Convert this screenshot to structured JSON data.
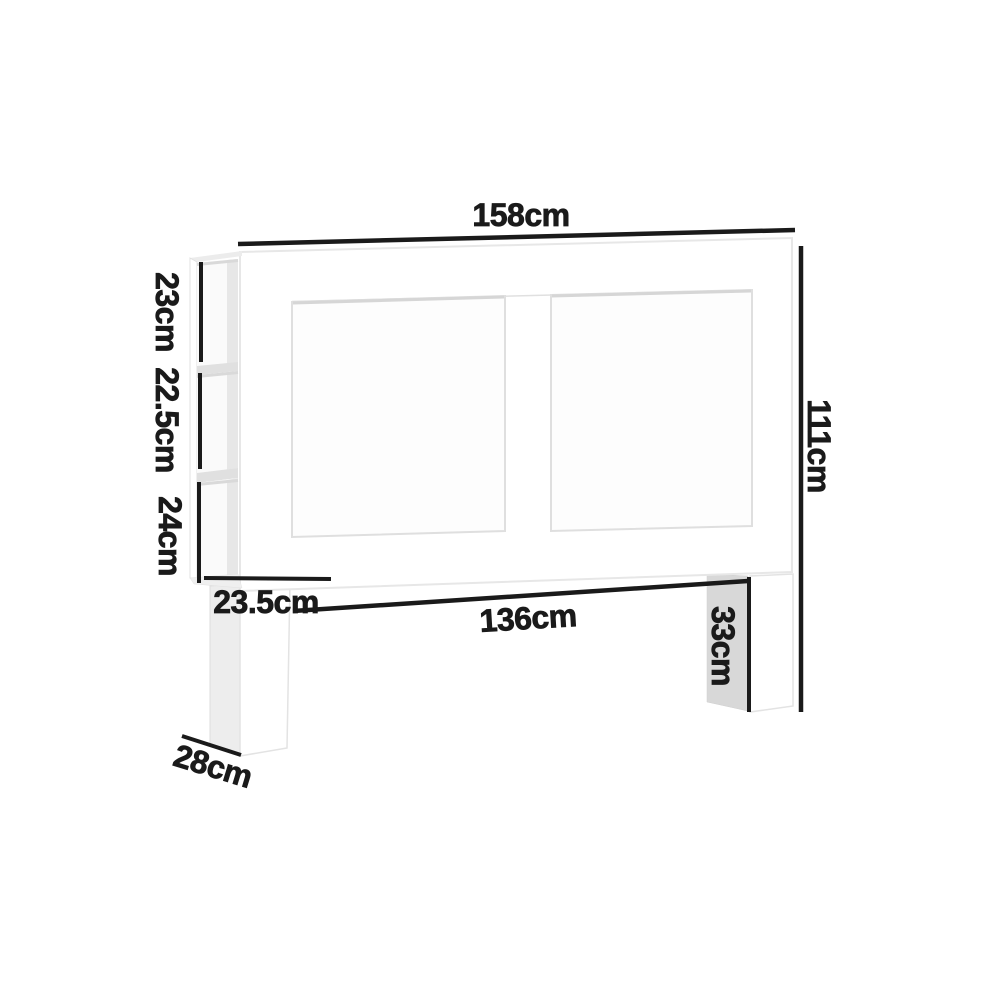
{
  "diagram": {
    "unit": "cm",
    "dimensions": {
      "total_width": "158cm",
      "total_height": "111cm",
      "cubby_top_height": "23cm",
      "cubby_middle_height": "22.5cm",
      "cubby_bottom_height": "24cm",
      "shelf_depth": "23.5cm",
      "inner_width": "136cm",
      "leg_height": "33cm",
      "base_depth": "28cm"
    },
    "colors": {
      "dimension_line": "#1a1a1a",
      "label_text": "#1a1a1a",
      "furniture_white": "#ffffff",
      "panel_fill": "#fdfdfd",
      "leg_side_shadow": "#d8d8d8",
      "shelf_side_shadow": "#ededed",
      "cubby_interior": "#fafafa",
      "cubby_shade": "#e7e7e7",
      "shelf_board": "#e0e0e0",
      "edge_line": "#e3e3e3"
    }
  }
}
